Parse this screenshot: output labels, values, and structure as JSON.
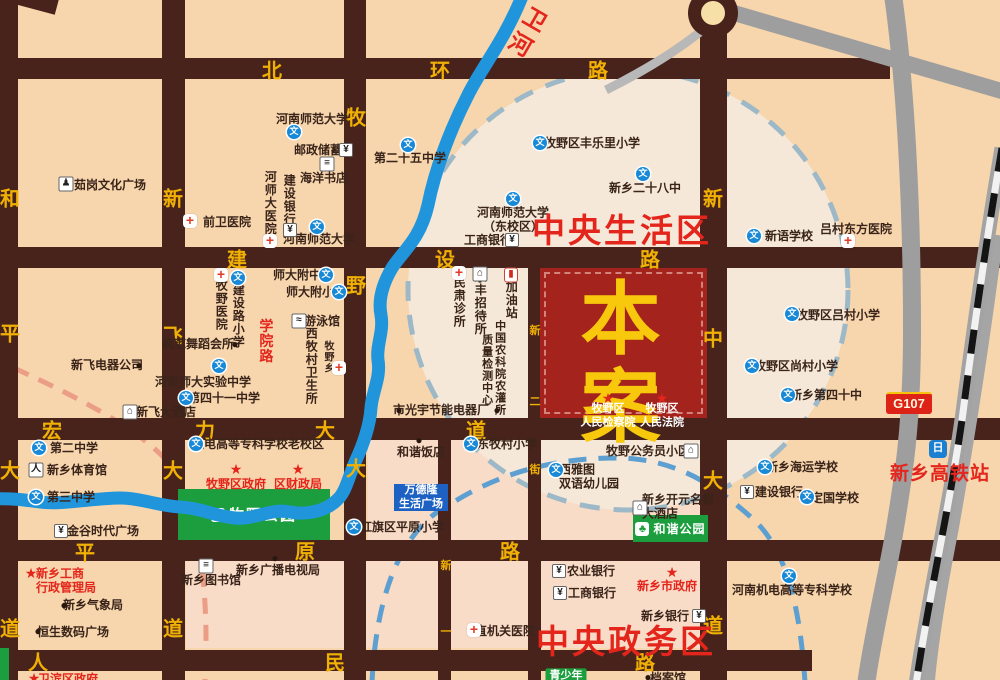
{
  "map": {
    "colors": {
      "background_tan": "#f7d6ad",
      "circle_pale": "#f5e8d8",
      "pink_zone": "#f8dcc7",
      "road_brown": "#48231b",
      "road_label_yellow": "#f1b104",
      "river_blue": "#2095dc",
      "park_green": "#1d9e3e",
      "accent_red": "#e4251c",
      "project_red": "#a5231d",
      "project_text_yellow": "#f7c80b",
      "gray_road": "#9e9e9e",
      "dashed_blue": "#5d9fd0",
      "dashed_gray": "#9db8c6",
      "dashed_salmon": "#eb9e85",
      "wandelong_blue": "#1d62c3"
    },
    "zones": {
      "living": {
        "text": "中央生活区"
      },
      "admin": {
        "text": "中央政务区"
      },
      "hsr": {
        "text": "新乡高铁站"
      },
      "river": {
        "text": "卫河"
      },
      "g107": {
        "text": "G107"
      },
      "project": {
        "text": "本案"
      }
    },
    "parks": {
      "muye": {
        "text": "牧野公园"
      },
      "hexie": {
        "text": "和谐公园"
      }
    },
    "wandelong": {
      "lines": [
        "万德隆",
        "生活广场"
      ]
    },
    "icon_glyphs": {
      "school": "文",
      "bank": "¥",
      "cross": "+",
      "dot": "●",
      "star": "★",
      "hotel": "⌂",
      "book": "≡",
      "statue": "♟",
      "swim": "≈",
      "sports": "人",
      "shop": "¥",
      "gas": "▮",
      "building": "⌂",
      "tree": "♣"
    },
    "road_labels": [
      {
        "ch": "北",
        "x": 272,
        "y": 69
      },
      {
        "ch": "环",
        "x": 440,
        "y": 69
      },
      {
        "ch": "路",
        "x": 598,
        "y": 69
      },
      {
        "ch": "建",
        "x": 237,
        "y": 258
      },
      {
        "ch": "设",
        "x": 445,
        "y": 258
      },
      {
        "ch": "路",
        "x": 650,
        "y": 258
      },
      {
        "ch": "宏",
        "x": 52,
        "y": 429
      },
      {
        "ch": "力",
        "x": 205,
        "y": 429
      },
      {
        "ch": "大",
        "x": 325,
        "y": 429
      },
      {
        "ch": "道",
        "x": 476,
        "y": 429
      },
      {
        "ch": "平",
        "x": 85,
        "y": 551
      },
      {
        "ch": "原",
        "x": 305,
        "y": 550
      },
      {
        "ch": "路",
        "x": 510,
        "y": 550
      },
      {
        "ch": "人",
        "x": 38,
        "y": 661
      },
      {
        "ch": "民",
        "x": 335,
        "y": 661
      },
      {
        "ch": "路",
        "x": 645,
        "y": 661
      },
      {
        "ch": "和",
        "x": 10,
        "y": 197
      },
      {
        "ch": "平",
        "x": 10,
        "y": 332
      },
      {
        "ch": "大",
        "x": 10,
        "y": 469
      },
      {
        "ch": "道",
        "x": 10,
        "y": 627
      },
      {
        "ch": "新",
        "x": 173,
        "y": 197
      },
      {
        "ch": "飞",
        "x": 173,
        "y": 334
      },
      {
        "ch": "大",
        "x": 173,
        "y": 469
      },
      {
        "ch": "道",
        "x": 173,
        "y": 627
      },
      {
        "ch": "牧",
        "x": 356,
        "y": 116
      },
      {
        "ch": "野",
        "x": 356,
        "y": 284
      },
      {
        "ch": "大",
        "x": 356,
        "y": 467
      },
      {
        "ch": "新",
        "x": 713,
        "y": 197
      },
      {
        "ch": "中",
        "x": 713,
        "y": 337
      },
      {
        "ch": "大",
        "x": 713,
        "y": 479
      },
      {
        "ch": "道",
        "x": 713,
        "y": 624
      },
      {
        "ch": "新",
        "x": 535,
        "y": 330,
        "s": 1
      },
      {
        "ch": "二",
        "x": 535,
        "y": 401,
        "s": 1
      },
      {
        "ch": "街",
        "x": 535,
        "y": 469,
        "s": 1
      },
      {
        "ch": "新",
        "x": 446,
        "y": 565,
        "s": 1
      },
      {
        "ch": "一",
        "x": 446,
        "y": 631,
        "s": 1
      }
    ],
    "pois": [
      {
        "t": "茹岗文化广场",
        "x": 110,
        "y": 185,
        "icon": "statue",
        "ix": 66,
        "iy": 184
      },
      {
        "t": "前卫医院",
        "x": 227,
        "y": 222,
        "icon": "cross",
        "ix": 190,
        "iy": 221
      },
      {
        "t": "河南师范大学",
        "x": 312,
        "y": 119,
        "icon": "school",
        "ix": 294,
        "iy": 132
      },
      {
        "t": "邮政储蓄",
        "x": 318,
        "y": 150,
        "icon": "bank",
        "ix": 346,
        "iy": 150
      },
      {
        "t": "海洋书店",
        "x": 324,
        "y": 178,
        "icon": "book",
        "ix": 327,
        "iy": 164
      },
      {
        "t": "建设银行",
        "x": 289,
        "y": 200,
        "o": "v",
        "icon": "bank",
        "ix": 290,
        "iy": 230
      },
      {
        "t": "河师大医院",
        "x": 270,
        "y": 203,
        "o": "v",
        "icon": "cross",
        "ix": 270,
        "iy": 241
      },
      {
        "t": "河南师范大学",
        "x": 319,
        "y": 239,
        "icon": "school",
        "ix": 317,
        "iy": 227
      },
      {
        "t": "第二十五中学",
        "x": 410,
        "y": 158,
        "icon": "school",
        "ix": 408,
        "iy": 145
      },
      {
        "t": "牧野区丰乐里小学",
        "x": 592,
        "y": 143,
        "icon": "school",
        "ix": 540,
        "iy": 143
      },
      {
        "t": "新乡二十八中",
        "x": 645,
        "y": 188,
        "icon": "school",
        "ix": 643,
        "iy": 174
      },
      {
        "lines": [
          "河南师范大学",
          "（东校区）"
        ],
        "x": 513,
        "y": 220,
        "icon": "school",
        "ix": 513,
        "iy": 199
      },
      {
        "t": "工商银行",
        "x": 488,
        "y": 240,
        "icon": "bank",
        "ix": 512,
        "iy": 240
      },
      {
        "t": "新语学校",
        "x": 789,
        "y": 236,
        "icon": "school",
        "ix": 754,
        "iy": 236
      },
      {
        "t": "吕村东方医院",
        "x": 856,
        "y": 229,
        "icon": "cross",
        "ix": 848,
        "iy": 241
      },
      {
        "t": "师大附中",
        "x": 297,
        "y": 275,
        "icon": "school",
        "ix": 326,
        "iy": 275
      },
      {
        "t": "师大附小",
        "x": 310,
        "y": 292,
        "icon": "school",
        "ix": 339,
        "iy": 292
      },
      {
        "t": "建设路小学",
        "x": 238,
        "y": 316,
        "o": "v",
        "icon": "school",
        "ix": 238,
        "iy": 278
      },
      {
        "t": "牧野医院",
        "x": 221,
        "y": 305,
        "o": "v",
        "icon": "cross",
        "ix": 221,
        "iy": 275
      },
      {
        "t": "游泳馆",
        "x": 322,
        "y": 321,
        "icon": "swim",
        "ix": 299,
        "iy": 321
      },
      {
        "t": "学院路",
        "x": 266,
        "y": 341,
        "o": "v",
        "c": "red",
        "fs": 14
      },
      {
        "t": "疯范舞蹈会所",
        "x": 198,
        "y": 344,
        "icon": "dot",
        "ix": 235,
        "iy": 344
      },
      {
        "t": "河南师大实验中学",
        "x": 203,
        "y": 382,
        "icon": "school",
        "ix": 219,
        "iy": 366
      },
      {
        "t": "第四十一中学",
        "x": 224,
        "y": 398,
        "icon": "school",
        "ix": 186,
        "iy": 398
      },
      {
        "t": "西牧村卫生所",
        "x": 311,
        "y": 366,
        "o": "v"
      },
      {
        "t": "牧野乡",
        "x": 327,
        "y": 357,
        "o": "v",
        "fs": 10,
        "icon": "cross",
        "ix": 339,
        "iy": 368
      },
      {
        "t": "新飞电器公司",
        "x": 107,
        "y": 365,
        "icon": "dot",
        "ix": 139,
        "iy": 365
      },
      {
        "t": "新飞大酒店",
        "x": 166,
        "y": 412,
        "icon": "hotel",
        "ix": 130,
        "iy": 412
      },
      {
        "t": "民肃诊所",
        "x": 459,
        "y": 302,
        "o": "v",
        "icon": "cross",
        "ix": 459,
        "iy": 273
      },
      {
        "t": "乐丰招待所",
        "x": 480,
        "y": 303,
        "o": "v",
        "icon": "hotel",
        "ix": 480,
        "iy": 274
      },
      {
        "t": "加油站",
        "x": 511,
        "y": 300,
        "o": "v",
        "icon": "gas",
        "ix": 511,
        "iy": 275
      },
      {
        "t": "中国农科院农灌所",
        "x": 499,
        "y": 368,
        "o": "v",
        "fs": 11
      },
      {
        "t": "质量检测中心",
        "x": 486,
        "y": 370,
        "o": "v",
        "fs": 11
      },
      {
        "icon": "dot",
        "ix": 497,
        "iy": 410
      },
      {
        "t": "市光宇节能电器厂",
        "x": 441,
        "y": 410,
        "icon": "dot",
        "ix": 399,
        "iy": 410
      },
      {
        "t": "和谐饭店",
        "x": 421,
        "y": 452,
        "icon": "dot",
        "ix": 419,
        "iy": 440
      },
      {
        "t": "东牧村小学",
        "x": 507,
        "y": 444,
        "icon": "school",
        "ix": 471,
        "iy": 444
      },
      {
        "t": "牧野公务员小区",
        "x": 648,
        "y": 451,
        "icon": "building",
        "ix": 691,
        "iy": 451
      },
      {
        "lines": [
          "西雅图",
          "双语幼儿园"
        ],
        "x": 589,
        "y": 477,
        "la": "left",
        "icon": "school",
        "ix": 556,
        "iy": 470
      },
      {
        "lines": [
          "新乡开元名都",
          "大酒店"
        ],
        "x": 678,
        "y": 507,
        "la": "left",
        "icon": "hotel",
        "ix": 640,
        "iy": 508
      },
      {
        "t": "机电高等专科学校老校区",
        "x": 258,
        "y": 444,
        "icon": "school",
        "ix": 196,
        "iy": 444
      },
      {
        "t": "牧野区政府",
        "x": 236,
        "y": 484,
        "c": "red",
        "icon": "star",
        "ix": 236,
        "iy": 469
      },
      {
        "t": "区财政局",
        "x": 298,
        "y": 484,
        "c": "red",
        "icon": "star",
        "ix": 298,
        "iy": 469
      },
      {
        "t": "红旗区平原小学",
        "x": 402,
        "y": 527,
        "icon": "school",
        "ix": 354,
        "iy": 527
      },
      {
        "t": "第二中学",
        "x": 74,
        "y": 448,
        "icon": "school",
        "ix": 39,
        "iy": 448
      },
      {
        "t": "新乡体育馆",
        "x": 77,
        "y": 470,
        "icon": "sports",
        "ix": 36,
        "iy": 470
      },
      {
        "t": "第三中学",
        "x": 71,
        "y": 497,
        "icon": "school",
        "ix": 36,
        "iy": 497
      },
      {
        "t": "金谷时代广场",
        "x": 103,
        "y": 531,
        "icon": "shop",
        "ix": 61,
        "iy": 531
      },
      {
        "lines": [
          "新乡工商",
          "行政管理局"
        ],
        "x": 66,
        "y": 581,
        "c": "red",
        "la": "left",
        "icon": "star",
        "ix": 31,
        "iy": 573
      },
      {
        "t": "新乡气象局",
        "x": 93,
        "y": 605,
        "icon": "dot",
        "ix": 64,
        "iy": 605
      },
      {
        "t": "恒生数码广场",
        "x": 73,
        "y": 632,
        "icon": "dot",
        "ix": 38,
        "iy": 631
      },
      {
        "t": "新乡图书馆",
        "x": 211,
        "y": 580,
        "icon": "book",
        "ix": 206,
        "iy": 566
      },
      {
        "t": "新乡广播电视局",
        "x": 278,
        "y": 570,
        "icon": "dot",
        "ix": 275,
        "iy": 558
      },
      {
        "t": "农业银行",
        "x": 591,
        "y": 571,
        "icon": "bank",
        "ix": 559,
        "iy": 571
      },
      {
        "t": "工商银行",
        "x": 592,
        "y": 593,
        "icon": "bank",
        "ix": 560,
        "iy": 593
      },
      {
        "t": "新乡市政府",
        "x": 667,
        "y": 586,
        "c": "red",
        "icon": "star",
        "ix": 672,
        "iy": 572
      },
      {
        "t": "新乡银行",
        "x": 665,
        "y": 616,
        "icon": "bank",
        "ix": 699,
        "iy": 616
      },
      {
        "t": "直机关医院",
        "x": 505,
        "y": 631,
        "icon": "cross",
        "ix": 474,
        "iy": 630
      },
      {
        "t": "牧野区吕村小学",
        "x": 838,
        "y": 315,
        "icon": "school",
        "ix": 792,
        "iy": 314
      },
      {
        "t": "牧野区尚村小学",
        "x": 796,
        "y": 366,
        "icon": "school",
        "ix": 752,
        "iy": 366
      },
      {
        "t": "新乡第四十中",
        "x": 826,
        "y": 395,
        "icon": "school",
        "ix": 788,
        "iy": 395
      },
      {
        "t": "新乡海运学校",
        "x": 802,
        "y": 467,
        "icon": "school",
        "ix": 765,
        "iy": 467
      },
      {
        "t": "建设银行",
        "x": 779,
        "y": 492,
        "icon": "bank",
        "ix": 747,
        "iy": 492
      },
      {
        "t": "定国学校",
        "x": 835,
        "y": 498,
        "icon": "school",
        "ix": 807,
        "iy": 497
      },
      {
        "t": "河南机电高等专科学校",
        "x": 792,
        "y": 590,
        "icon": "school",
        "ix": 789,
        "iy": 576
      },
      {
        "t": "青少年",
        "x": 566,
        "y": 676,
        "c": "white",
        "fs": 11,
        "box": "green"
      },
      {
        "t": "档案馆",
        "x": 668,
        "y": 678,
        "icon": "dot",
        "ix": 648,
        "iy": 677
      },
      {
        "t": "卫滨区政府",
        "x": 68,
        "y": 679,
        "c": "red",
        "icon": "star",
        "ix": 34,
        "iy": 678
      },
      {
        "icon": "star",
        "ix": 608,
        "iy": 398
      },
      {
        "icon": "star",
        "ix": 662,
        "iy": 398
      },
      {
        "t": "牧野区",
        "x": 608,
        "y": 409,
        "c": "white",
        "fs": 11
      },
      {
        "t": "人民检察院",
        "x": 608,
        "y": 423,
        "c": "white",
        "fs": 11
      },
      {
        "t": "牧野区",
        "x": 662,
        "y": 409,
        "c": "white",
        "fs": 11
      },
      {
        "t": "人民法院",
        "x": 662,
        "y": 423,
        "c": "white",
        "fs": 11
      }
    ]
  }
}
